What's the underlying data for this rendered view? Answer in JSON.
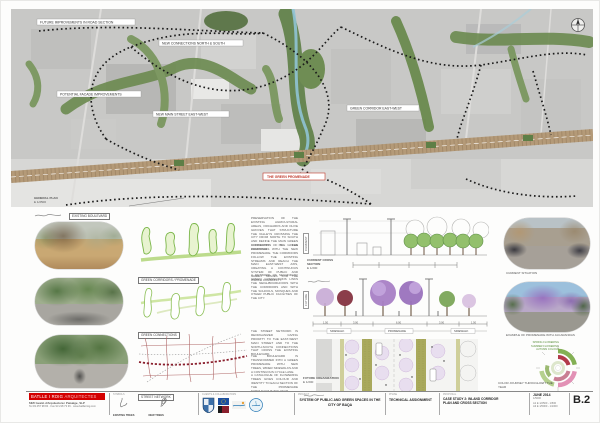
{
  "colors": {
    "accent_red": "#c0392b",
    "diagram_green": "#7ab648",
    "boulevard_tan": "#b49a78",
    "jacaranda": "#a87fc5"
  },
  "map": {
    "labels": {
      "l1": "FUTURE IMPROVEMENTS IN ROAD SECTION",
      "l2": "NEW CONNECTIONS NORTH & SOUTH",
      "l3": "POTENTIAL FACADE IMPROVEMENTS",
      "l4": "NEW MAIN STREET EAST-WEST",
      "l5": "GREEN CORRIDOR EAST-WEST",
      "promenade": "THE GREEN PROMENADE",
      "existing_boulevard": "EXISTING BOULEVARD"
    },
    "scale_note": {
      "line1": "GENERAL PLAN",
      "line2": "E 1/2500"
    }
  },
  "diagrams": {
    "d1_label": "GREEN CORRIDORS / PROMENADE",
    "d2_label": "GREEN CONNECTIONS",
    "d3_label": "STREET NETWORK"
  },
  "notes": [
    "PRESERVATION OF THE EXISTING AGRICULTURAL AREAS, ORCHARDS AND OLIVE GROVES THAT STRUCTURE THE VALLEYS CROSSING THE CITY FROM NORTH TO SOUTH AND DEFINE THE MAIN GREEN CORRIDORS OF THE PROPOSAL.",
    "CONNECTION OF THE GREEN CORRIDORS WITH THE NEW PROMENADE. THE CORRIDORS FOLLOW THE EXISTING STREAMS AND REACH THE MAIN EAST-WEST AXIS, CREATING A CONTINUOUS SYSTEM OF PUBLIC AND GREEN SPACES FOR THE WHOLE COMMUNITY.",
    "A NETWORK OF SECONDARY GREEN CONNECTIONS LINKS THE NEIGHBOURHOODS WITH THE CORRIDORS AND WITH THE SCHOOLS, MOSQUES AND OTHER PUBLIC FACILITIES OF THE CITY.",
    "THE STREET NETWORK IS REORGANIZED GIVING PRIORITY TO THE EAST-WEST MAIN STREET AND TO THE NORTH-SOUTH CONNECTIONS THAT CROSS THE EXISTING BOULEVARD.",
    "THE BOULEVARD IS TRANSFORMED INTO A GREEN PROMENADE WITH NEW TREES, WIDER SIDEWALKS AND A CONTINUOUS CYCLE LANE.",
    "A CATALOGUE OF FLOWERING TREES GIVES COLOUR AND IDENTITY TO EACH SECTION OF THE PROMENADE THROUGHOUT THE YEAR."
  ],
  "sections": {
    "current": {
      "side": "CURRENT",
      "cap1": "CURRENT CROSS SECTION",
      "cap2": "E 1/200"
    },
    "future": {
      "side": "FUTURE",
      "cap1": "FUTURE CROSS SECTION",
      "cap2": "E 1/200"
    },
    "plan": {
      "cap1": "FUTURE URBANIZATION",
      "cap2": "E 1/200"
    },
    "dims": {
      "d1": "1.50",
      "d2": "3.00",
      "d3": "6.00",
      "d4": "3.00",
      "d5": "1.50",
      "t1": "SIDEWALK",
      "t2": "PROMENADE",
      "t3": "SIDEWALK"
    }
  },
  "right": {
    "photo1_caption": "CURRENT SITUATION",
    "photo2_caption": "EXAMPLE OF PROMENADE WITH JACARANDAS",
    "chart": {
      "legend": [
        "SPRING FLOWERING",
        "SUMMER FLOWERING",
        "AUTUMN COLOUR"
      ],
      "caption": "COLOR JOURNEY THROUGHOUT THE YEAR"
    }
  },
  "titleblock": {
    "firm": {
      "name": "BATLLE I ROIG",
      "name2": "ARQUITECTES",
      "line1": "MMI Gestió d'Arquitectura i Paisatge, SLP",
      "line2": "Tel 93 457 98 84 · Fax 93 218 73 36 · www.batlleiroig.com"
    },
    "symbols": {
      "header": "SYMBOLS",
      "item1": "EXISTING TREES",
      "item2": "NEW TREES"
    },
    "logos_header": "CLIENTS & COLLABORATORS",
    "project": {
      "header": "PROJECT",
      "title": "SYSTEM OF PUBLIC AND GREEN SPACES IN THE CITY OF BAQA"
    },
    "phase": {
      "header": "PHASE",
      "title": "TECHNICAL ASSIGNMENT"
    },
    "drawing": {
      "header": "PROPOSAL",
      "line1": "CASE STUDY 2: INLAND CORRIDOR",
      "line2": "PLAN AND CROSS SECTION"
    },
    "date": {
      "line1": "JUNE 2014",
      "line2": "1/5000",
      "scale1": "A1 E 1/2500 - 1/500",
      "scale2": "A3 E 1/5000 - 1/1000"
    },
    "sheet_number": "B.2"
  }
}
